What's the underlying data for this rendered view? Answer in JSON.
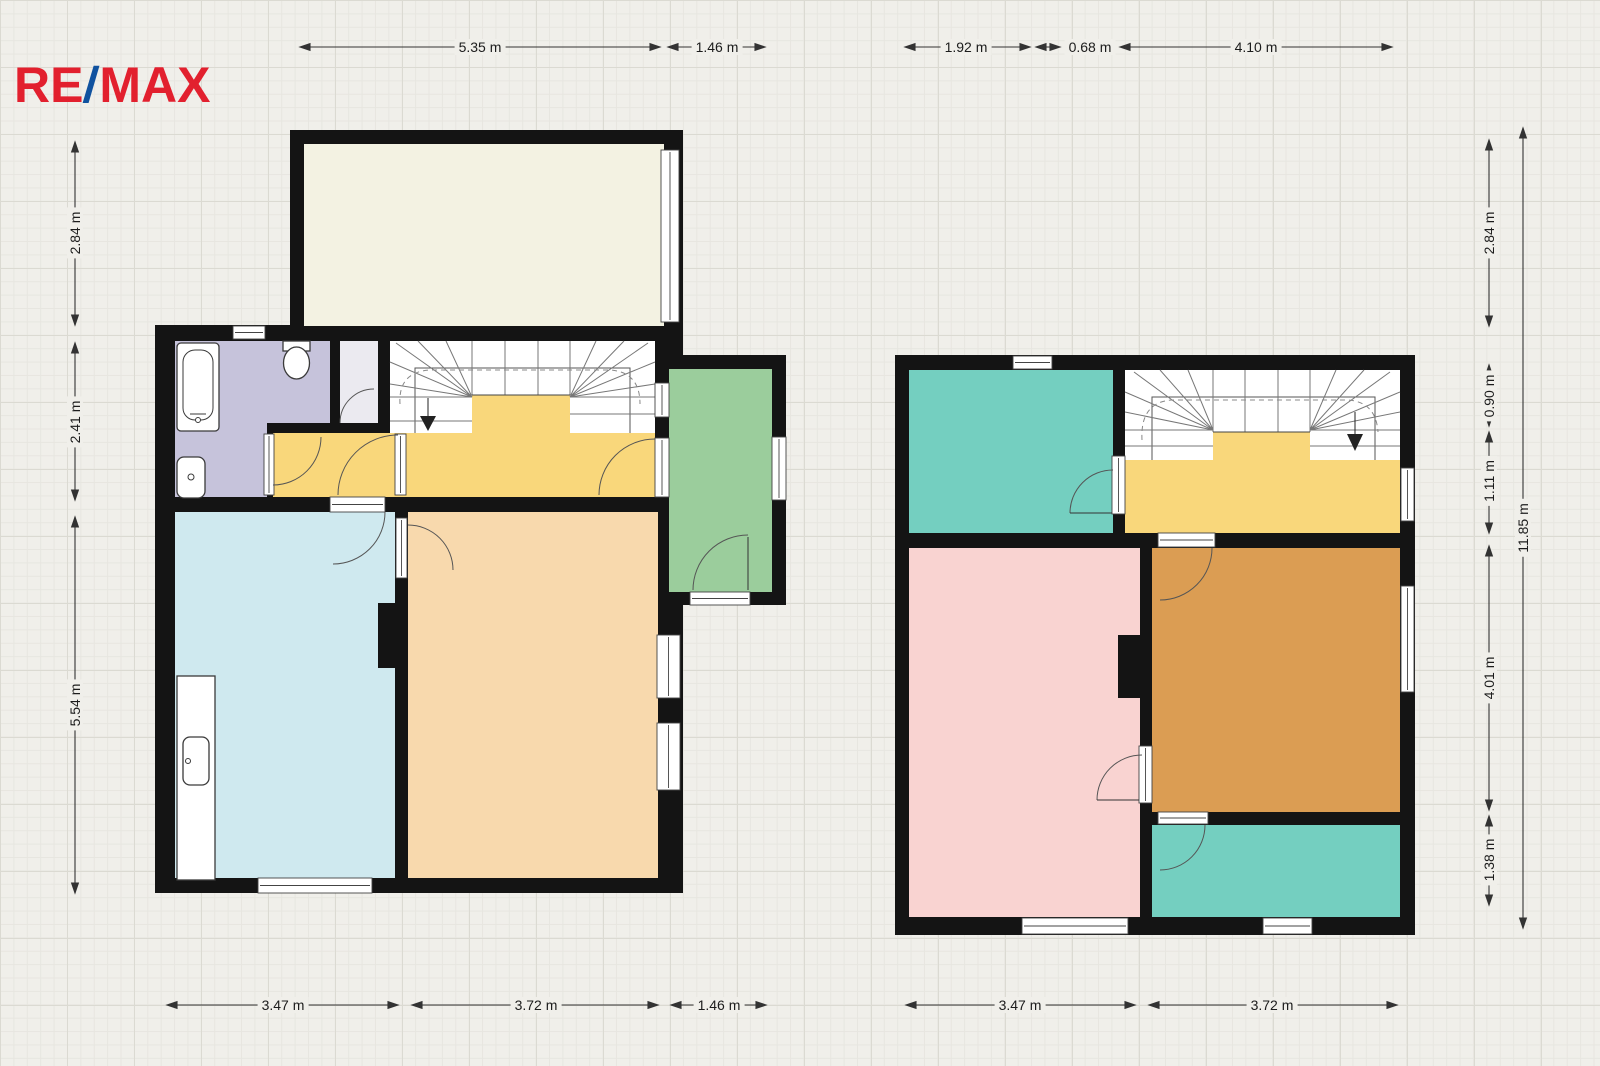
{
  "brand": {
    "logo_re": "RE",
    "logo_slash": "/",
    "logo_max": "MAX",
    "red": "#e2202e",
    "blue": "#10529f"
  },
  "dimensions": {
    "floor1": {
      "top": [
        "5.35 m",
        "1.46 m"
      ],
      "left": [
        "2.84 m",
        "2.41 m",
        "5.54 m"
      ],
      "bottom": [
        "3.47 m",
        "3.72 m",
        "1.46 m"
      ]
    },
    "floor2": {
      "top": [
        "1.92 m",
        "0.68 m",
        "4.10 m"
      ],
      "right": [
        "2.84 m",
        "0.90 m",
        "1.11 m",
        "4.01 m",
        "1.38 m"
      ],
      "right_total": "11.85 m",
      "bottom": [
        "3.47 m",
        "3.72 m"
      ]
    }
  },
  "colors": {
    "background": "#f0efea",
    "wall": "#141414",
    "terrace": "#f3f2e2",
    "bathroom": "#c6c3db",
    "closet": "#ebeaf0",
    "hall_yellow": "#f9d77b",
    "stairs_white": "#ffffff",
    "veranda_green": "#9bcd9c",
    "kitchen_blue": "#cfe9ef",
    "living_peach": "#f8d9ad",
    "room_teal": "#74cfc0",
    "bedroom_pink": "#f9d3d1",
    "bedroom_brown": "#db9d53",
    "dim_line": "#333333"
  }
}
